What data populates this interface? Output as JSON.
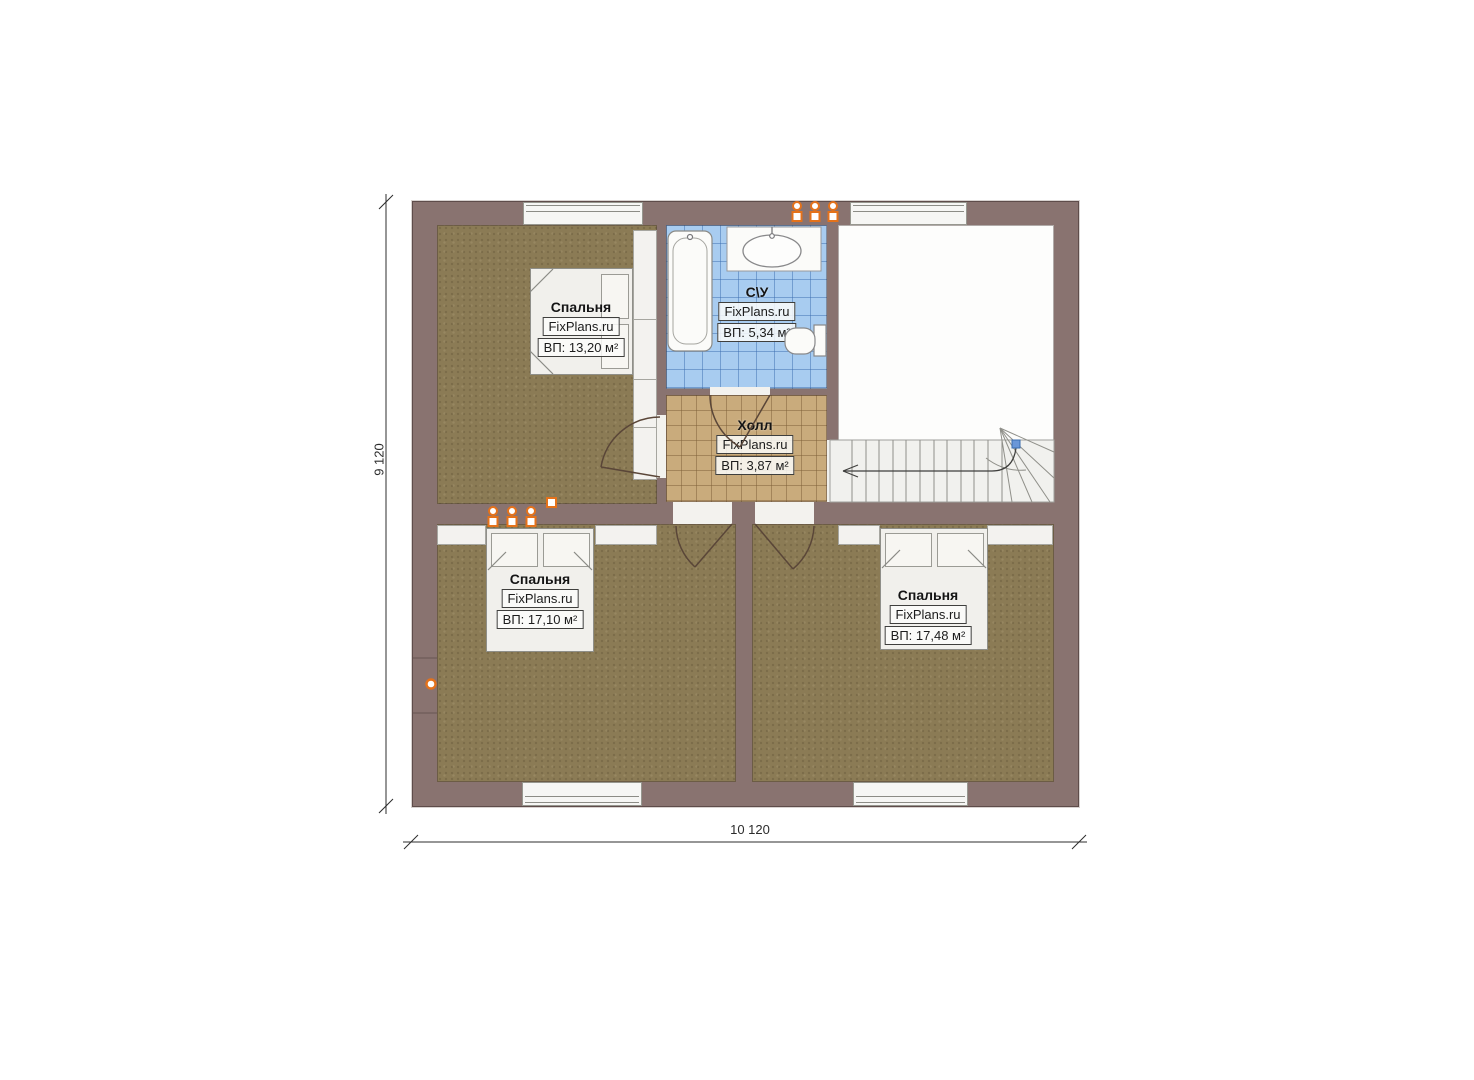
{
  "plan": {
    "watermark": "FixPlans.ru",
    "dimensions": {
      "height": "9 120",
      "width": "10 120"
    },
    "rooms": {
      "bedroom_top_left": {
        "name": "Спальня",
        "watermark": "FixPlans.ru",
        "area": "ВП: 13,20 м²"
      },
      "bathroom": {
        "name": "С\\У",
        "watermark": "FixPlans.ru",
        "area": "ВП: 5,34 м²"
      },
      "hall": {
        "name": "Холл",
        "watermark": "FixPlans.ru",
        "area": "ВП: 3,87 м²"
      },
      "bedroom_bottom_left": {
        "name": "Спальня",
        "watermark": "FixPlans.ru",
        "area": "ВП: 17,10 м²"
      },
      "bedroom_bottom_right": {
        "name": "Спальня",
        "watermark": "FixPlans.ru",
        "area": "ВП: 17,48 м²"
      }
    },
    "colors": {
      "wall": "#897370",
      "bedroom_floor": "#8b7b55",
      "hall_floor": "#c9ab7c",
      "bathroom_floor": "#a8ccf0",
      "radiator_orange": "#e4721b",
      "stair_marker_blue": "#6b97d8"
    }
  }
}
